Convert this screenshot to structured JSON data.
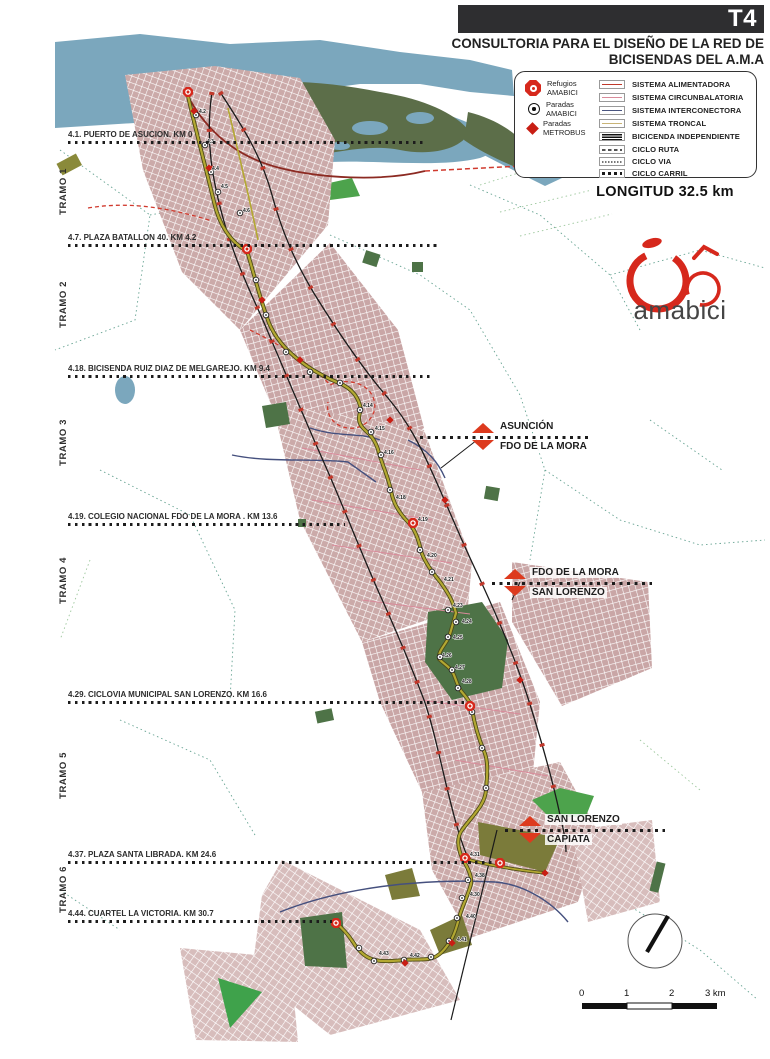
{
  "header": {
    "tag": "T4",
    "title_line1": "CONSULTORIA PARA EL DISEÑO DE LA RED DE",
    "title_line2": "BICISENDAS DEL A.M.A"
  },
  "legend": {
    "point_items": [
      {
        "icon": "refugio-amabici-icon",
        "line1": "Refugios",
        "line2": "AMABICI"
      },
      {
        "icon": "parada-amabici-icon",
        "line1": "Paradas",
        "line2": "AMABICI"
      },
      {
        "icon": "parada-metrobus-icon",
        "line1": "Paradas",
        "line2": "METROBUS"
      }
    ],
    "line_items": [
      {
        "label": "SISTEMA ALIMENTADORA",
        "style": "solid",
        "color": "#c0392b"
      },
      {
        "label": "SISTEMA  CIRCUNBALATORIA",
        "style": "solid",
        "color": "#d98a9a"
      },
      {
        "label": "SISTEMA INTERCONECTORA",
        "style": "solid",
        "color": "#4a5580"
      },
      {
        "label": "SISTEMA TRONCAL",
        "style": "solid",
        "color": "#c9b476"
      },
      {
        "label": "BICICENDA INDEPENDIENTE",
        "style": "double",
        "color": "#1a1a1a"
      },
      {
        "label": "CICLO RUTA",
        "style": "dashed",
        "color": "#555555"
      },
      {
        "label": "CICLO VIA",
        "style": "fine-dashed",
        "color": "#777777"
      },
      {
        "label": "CICLO CARRIL",
        "style": "square-dotted",
        "color": "#1a1a1a"
      }
    ]
  },
  "longitud_label": "LONGITUD 32.5 km",
  "logo": {
    "text": "amabici",
    "accent_color": "#d6281c"
  },
  "tramos": [
    {
      "label": "TRAMO 1"
    },
    {
      "label": "TRAMO 2"
    },
    {
      "label": "TRAMO 3"
    },
    {
      "label": "TRAMO 4"
    },
    {
      "label": "TRAMO 5"
    },
    {
      "label": "TRAMO 6"
    }
  ],
  "waypoints": [
    {
      "label": "4.1. PUERTO DE ASUCION. KM 0"
    },
    {
      "label": "4.7. PLAZA BATALLON 40. KM 4.2"
    },
    {
      "label": "4.18. BICISENDA RUIZ DIAZ DE MELGAREJO. KM 9.4"
    },
    {
      "label": "4.19. COLEGIO NACIONAL FDO DE LA MORA . KM 13.6"
    },
    {
      "label": "4.29. CICLOVIA MUNICIPAL SAN LORENZO. KM 16.6"
    },
    {
      "label": "4.37. PLAZA SANTA LIBRADA. KM 24.6"
    },
    {
      "label": "4.44. CUARTEL LA VICTORIA. KM 30.7"
    }
  ],
  "boundaries": [
    {
      "top": "ASUNCIÓN",
      "bottom": "FDO DE LA MORA"
    },
    {
      "top": "FDO DE LA MORA",
      "bottom": "SAN LORENZO"
    },
    {
      "top": "SAN LORENZO",
      "bottom": "CAPIATA"
    }
  ],
  "scalebar": {
    "ticks": [
      "0",
      "1",
      "2",
      "3 km"
    ]
  },
  "map_annotations": {
    "route_point_labels": [
      {
        "label": "4.2",
        "x": 199,
        "y": 113
      },
      {
        "label": "4.3",
        "x": 207,
        "y": 143
      },
      {
        "label": "4.4",
        "x": 212,
        "y": 170
      },
      {
        "label": "4.5",
        "x": 221,
        "y": 188
      },
      {
        "label": "4.6",
        "x": 243,
        "y": 212
      },
      {
        "label": "4.14",
        "x": 363,
        "y": 407
      },
      {
        "label": "4.15",
        "x": 375,
        "y": 430
      },
      {
        "label": "4.16",
        "x": 384,
        "y": 454
      },
      {
        "label": "4.18",
        "x": 396,
        "y": 499
      },
      {
        "label": "4.19",
        "x": 418,
        "y": 521
      },
      {
        "label": "4.20",
        "x": 427,
        "y": 557
      },
      {
        "label": "4.21",
        "x": 444,
        "y": 581
      },
      {
        "label": "4.23",
        "x": 453,
        "y": 607
      },
      {
        "label": "4.24",
        "x": 462,
        "y": 623
      },
      {
        "label": "4.25",
        "x": 453,
        "y": 639
      },
      {
        "label": "4.26",
        "x": 442,
        "y": 657
      },
      {
        "label": "4.27",
        "x": 455,
        "y": 669
      },
      {
        "label": "4.28",
        "x": 462,
        "y": 683
      },
      {
        "label": "4.31",
        "x": 470,
        "y": 856
      },
      {
        "label": "4.38",
        "x": 475,
        "y": 877
      },
      {
        "label": "4.30",
        "x": 470,
        "y": 896
      },
      {
        "label": "4.40",
        "x": 466,
        "y": 918
      },
      {
        "label": "4.41",
        "x": 457,
        "y": 941
      },
      {
        "label": "4.42",
        "x": 410,
        "y": 957
      },
      {
        "label": "4.43",
        "x": 379,
        "y": 955
      }
    ]
  },
  "colors": {
    "river": "#7ba7bd",
    "wetland": "#5c6e49",
    "park": "#4e7347",
    "bright_green": "#4da34c",
    "urban_grid": "#cbaaa9",
    "troncal_route": "#aa9e2e",
    "alimentadora": "#a8281e",
    "interconectora": "#45507e",
    "boundary_dotted": "#66a392",
    "marker_red": "#d6281c"
  }
}
